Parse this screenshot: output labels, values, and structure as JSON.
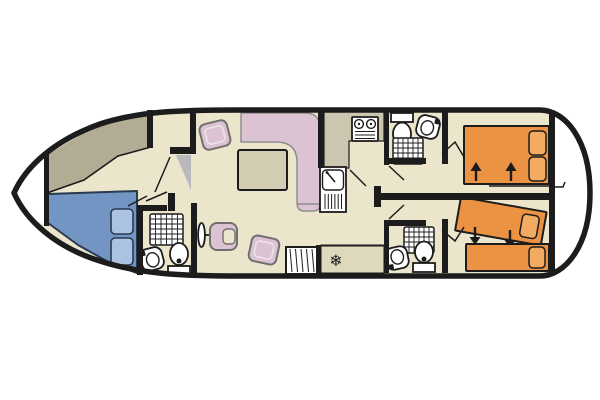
{
  "diagram": {
    "kind": "boat-floorplan",
    "freezer_icon": "❄"
  },
  "colors": {
    "outline": "#1c1c1c",
    "floor": "#ebe6cb",
    "deck": "#b2ac95",
    "counter": "#cbc6af",
    "appliance_zone": "#ded8bd",
    "door_panel": "#b9b9bd",
    "fixture_white": "#ffffff",
    "bed_blue": "#7295c3",
    "pillow_blue": "#abc2e0",
    "bed_blue_outline": "#2b3a50",
    "seat_pink": "#dcc3d3",
    "seat_outline": "#6f6f6f",
    "sofa_outline": "#8e8e8e",
    "table": "#d2ccb2",
    "bed_orange": "#ec9243",
    "pillow_orange": "#f2ab61"
  }
}
